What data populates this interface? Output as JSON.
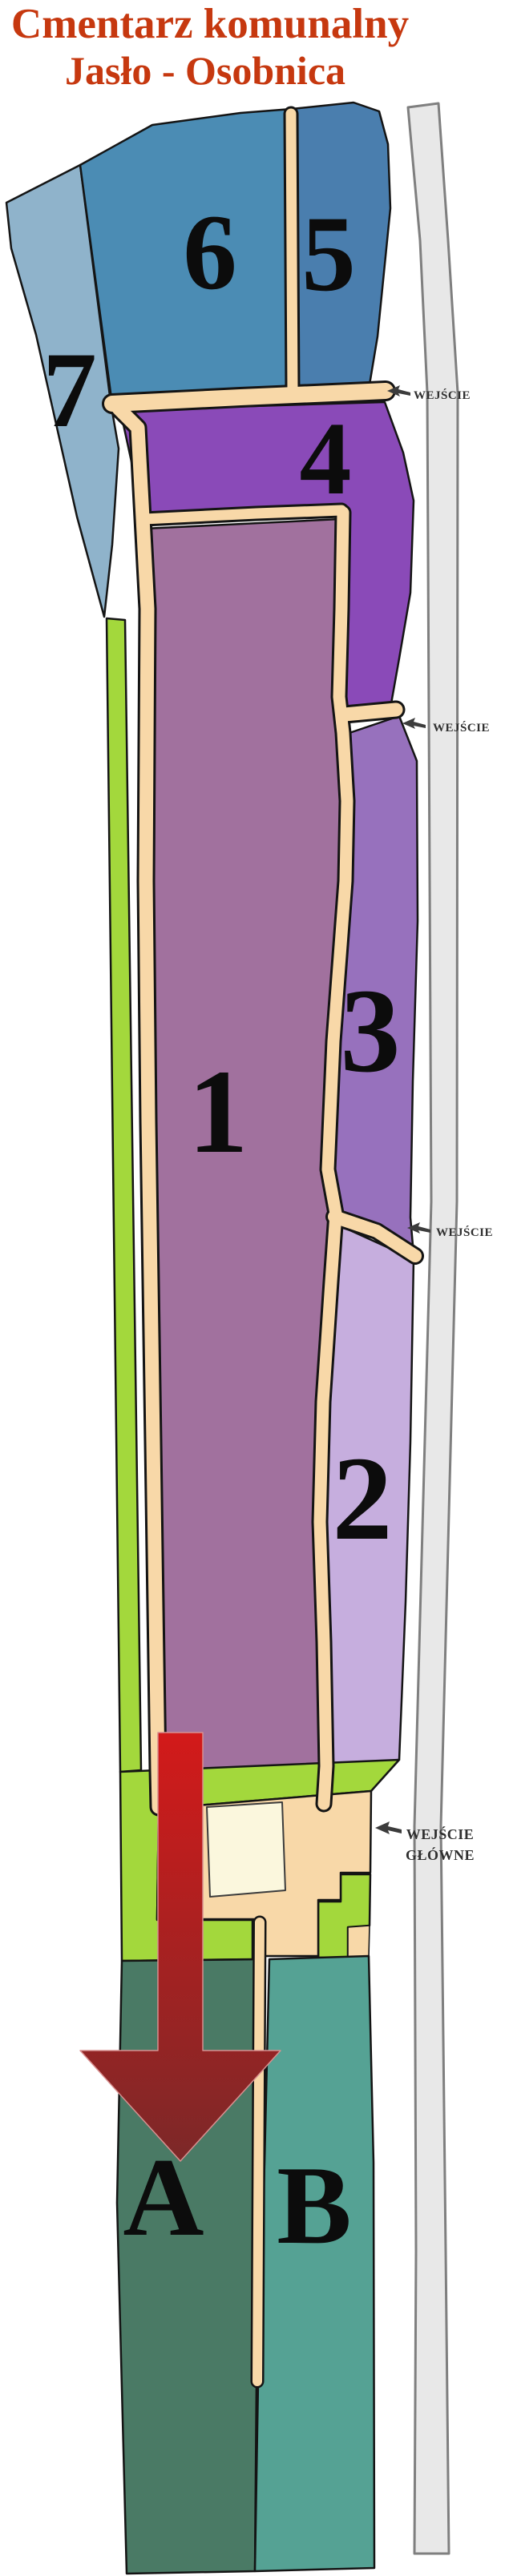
{
  "title": {
    "line1": "Cmentarz komunalny",
    "line2": "Jasło - Osobnica",
    "color": "#c6380f"
  },
  "sections": {
    "s1": {
      "label": "1",
      "color": "#a1719e"
    },
    "s2": {
      "label": "2",
      "color": "#c6aede"
    },
    "s3": {
      "label": "3",
      "color": "#9771bd"
    },
    "s4": {
      "label": "4",
      "color": "#8a4ab8"
    },
    "s5": {
      "label": "5",
      "color": "#4a7eae"
    },
    "s6": {
      "label": "6",
      "color": "#4b8cb4"
    },
    "s7": {
      "label": "7",
      "color": "#8fb3cb"
    },
    "sA": {
      "label": "A",
      "color": "#4a7a65"
    },
    "sB": {
      "label": "B",
      "color": "#55a294"
    }
  },
  "entrances": {
    "e1": {
      "label": "WEJŚCIE"
    },
    "e2": {
      "label": "WEJŚCIE"
    },
    "e3": {
      "label": "WEJŚCIE"
    },
    "e4": {
      "line1": "WEJŚCIE",
      "line2": "GŁÓWNE"
    }
  },
  "arrow": {
    "top_color": "#d31a1a",
    "bottom_color": "#7c2828"
  },
  "colors": {
    "path": "#f8d8a8",
    "green": "#a3d83c",
    "road_fill": "#e8e8e8",
    "road_border": "#7f7f7f",
    "building_fill": "#fbf7dd",
    "building_stroke": "#3c3c3c",
    "entrance_text": "#2f2f2f",
    "entrance_arrow": "#3c3c3c"
  }
}
